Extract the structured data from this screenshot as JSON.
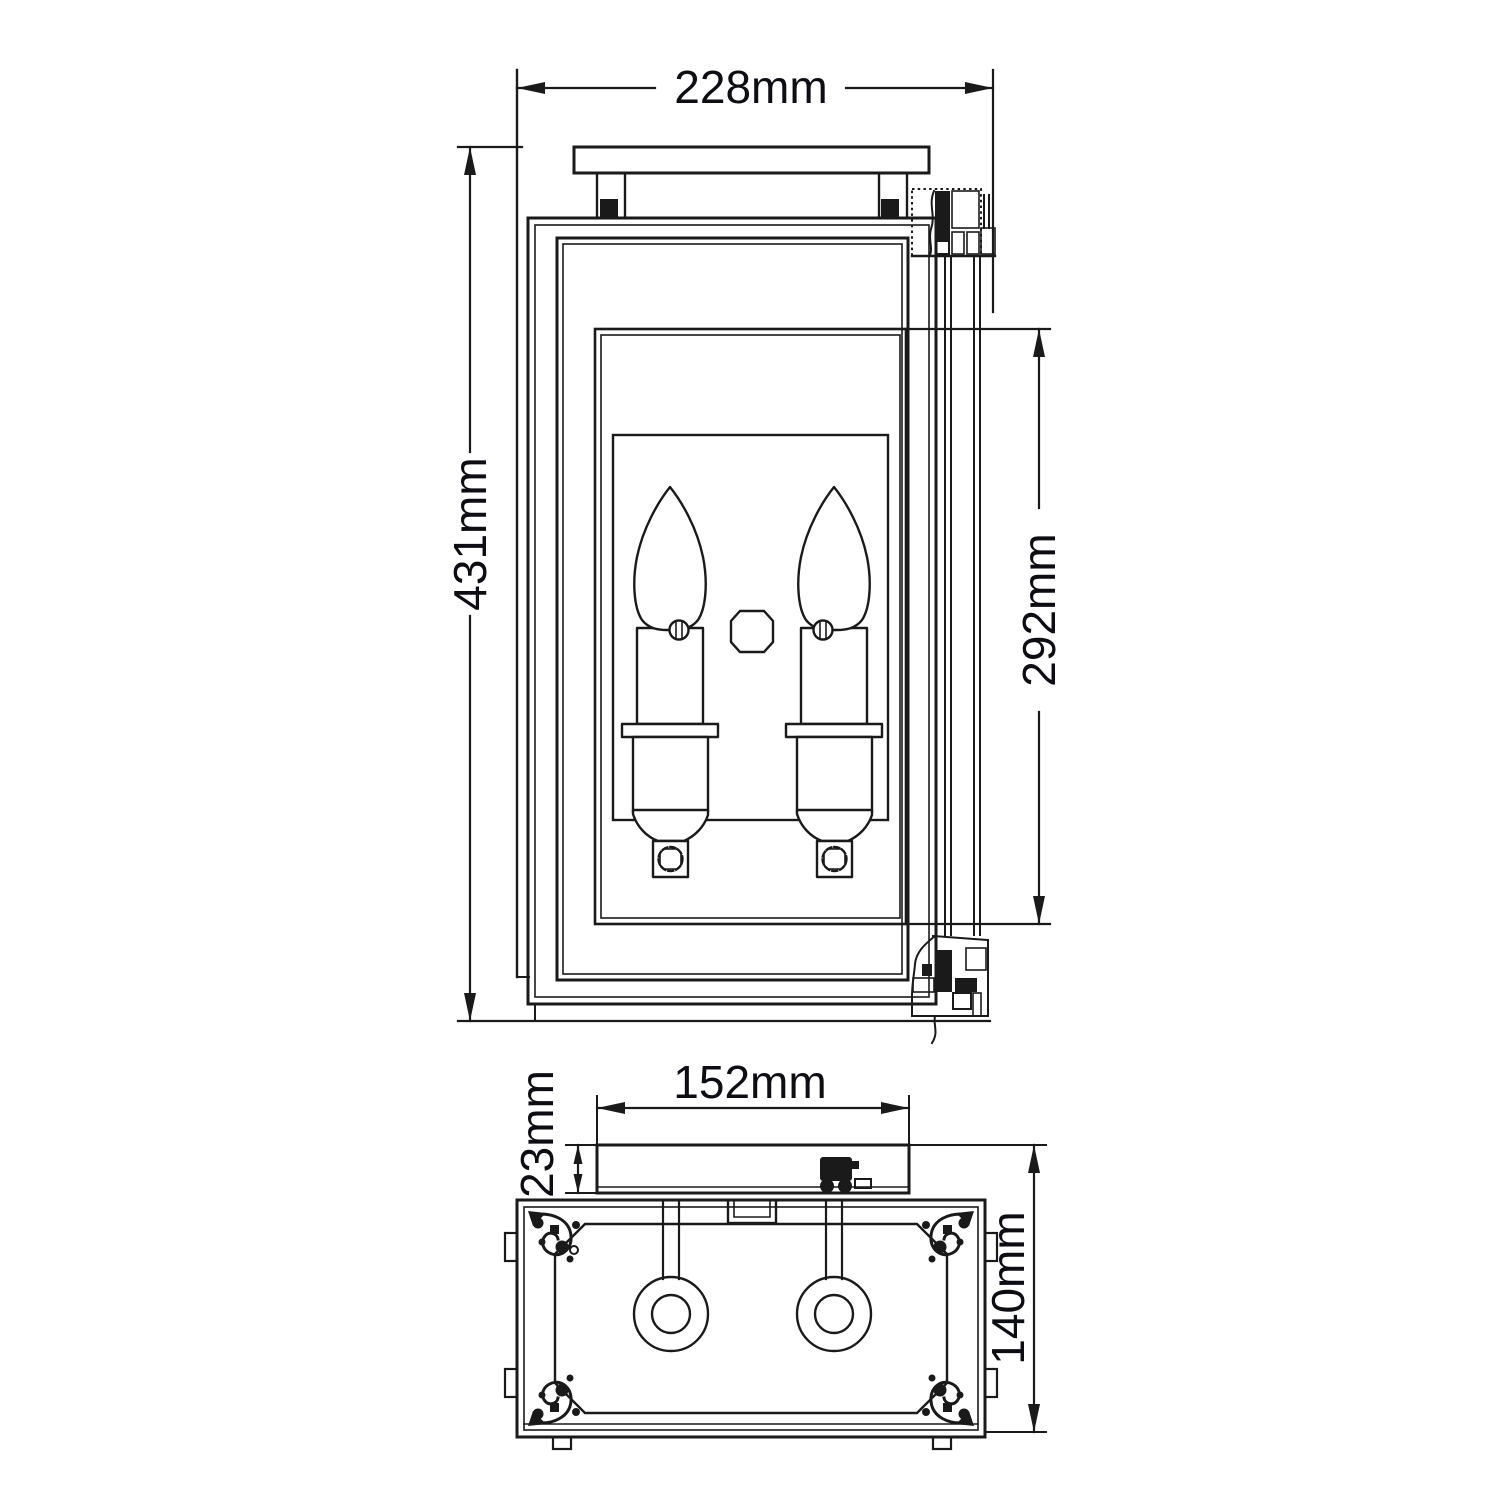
{
  "drawing": {
    "type": "technical-dimension-drawing",
    "background": "#ffffff",
    "line_color": "#1a1a1a",
    "text_color": "#0d0d14",
    "front_view": {
      "width_dim": "228mm",
      "height_dim": "431mm",
      "inner_height_dim": "292mm",
      "lamp_count": 2
    },
    "plan_view": {
      "backplate_width_dim": "152mm",
      "backplate_depth_dim": "23mm",
      "depth_dim": "140mm",
      "socket_count": 2
    }
  }
}
